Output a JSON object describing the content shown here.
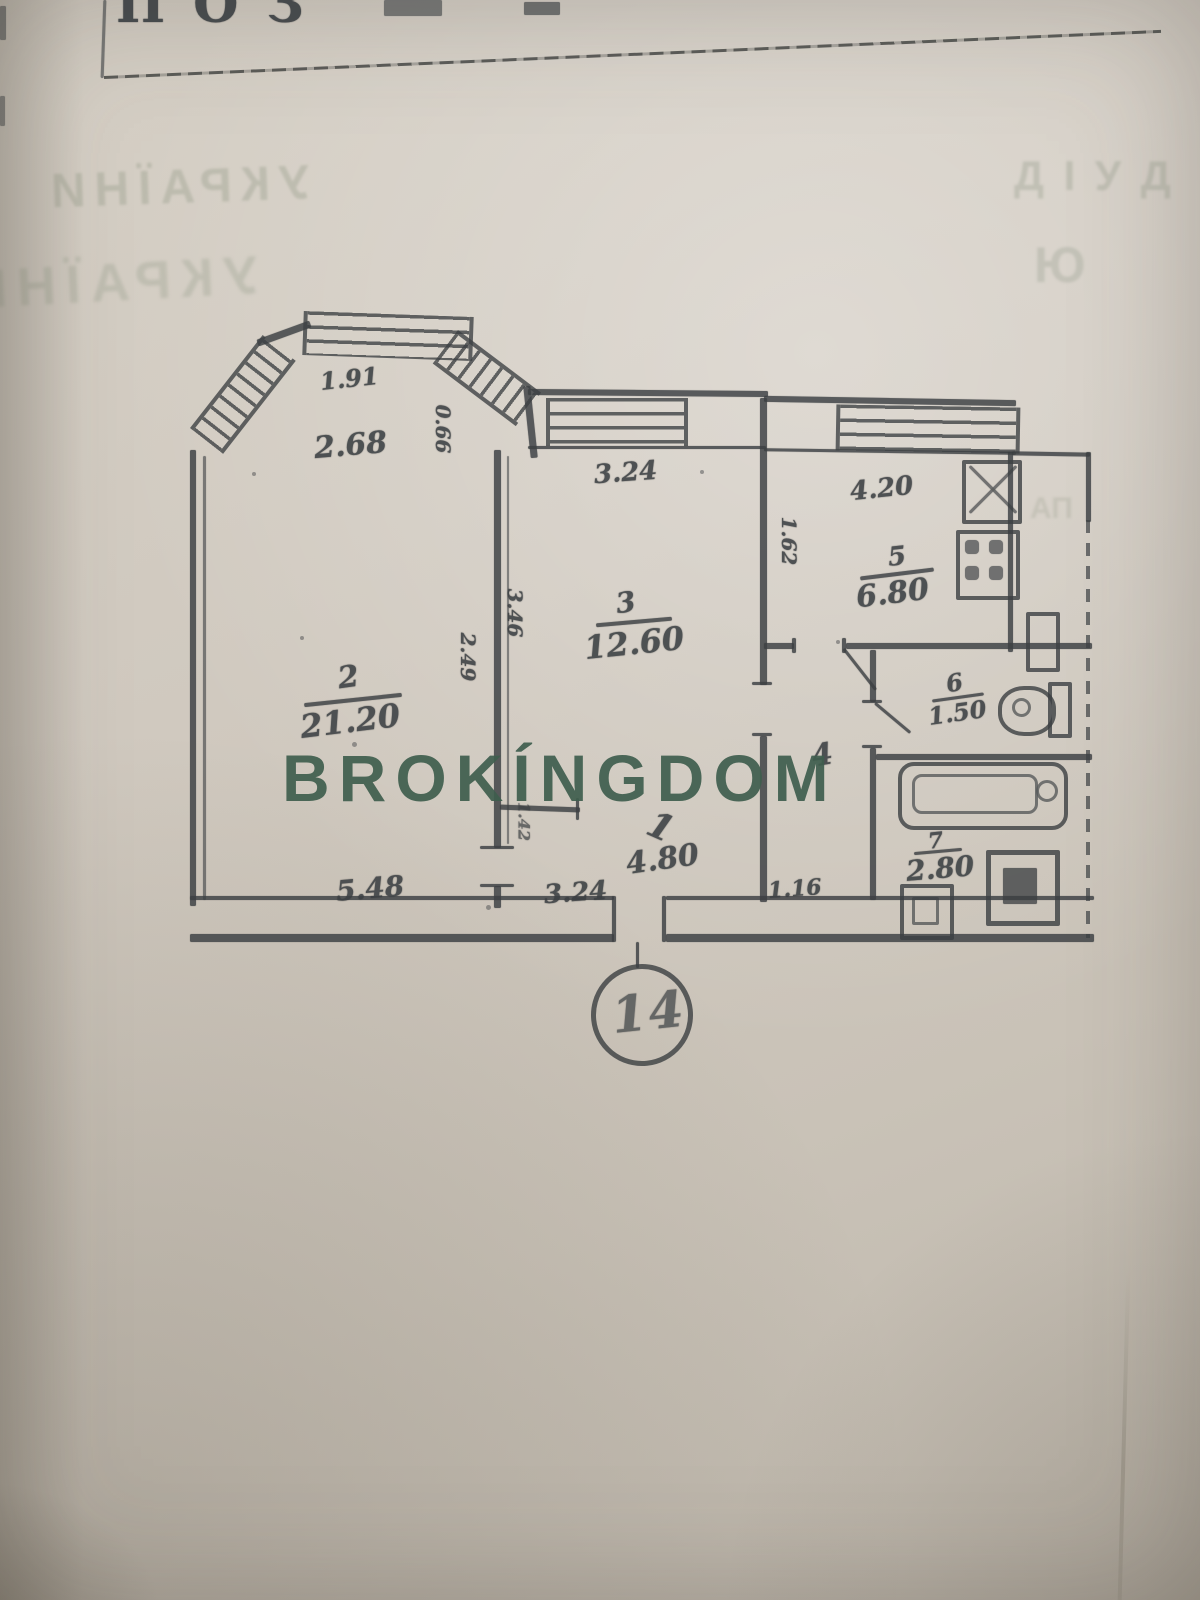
{
  "photo": {
    "header_clipped_text": "ПОЗ",
    "watermark": "BROKÍNGDOM"
  },
  "bleedthrough": {
    "left_line1": "УКРАЇНИ",
    "left_line2": "УКРАЇНИ",
    "right_marks": [
      "Д І У Д",
      "Ю",
      "АП"
    ]
  },
  "plan": {
    "apartment_badge": "14",
    "rooms": [
      {
        "id": "hall",
        "number": "1",
        "area": "4.80"
      },
      {
        "id": "living",
        "number": "2",
        "area": "21.20"
      },
      {
        "id": "bedroom",
        "number": "3",
        "area": "12.60"
      },
      {
        "id": "corridor",
        "number": "4",
        "area": ""
      },
      {
        "id": "kitchen",
        "number": "5",
        "area": "6.80"
      },
      {
        "id": "wc",
        "number": "6",
        "area": "1.50"
      },
      {
        "id": "bath",
        "number": "7",
        "area": "2.80"
      }
    ],
    "dimensions": {
      "bay_top": "1.91",
      "bay_width": "2.68",
      "bay_side": "0.66",
      "room3_top": "3.24",
      "right_top": "4.20",
      "kitchen_depth": "1.62",
      "wall_left": "2.49",
      "wall_right": "3.46",
      "hall_side": "1.42",
      "room2_bottom": "5.48",
      "hall_bottom": "3.24",
      "corridor_bottom": "1.16"
    },
    "colors": {
      "ink": "#3b3f42",
      "watermark_green": "#3f5e4e",
      "paper": "#cfc8be"
    }
  }
}
